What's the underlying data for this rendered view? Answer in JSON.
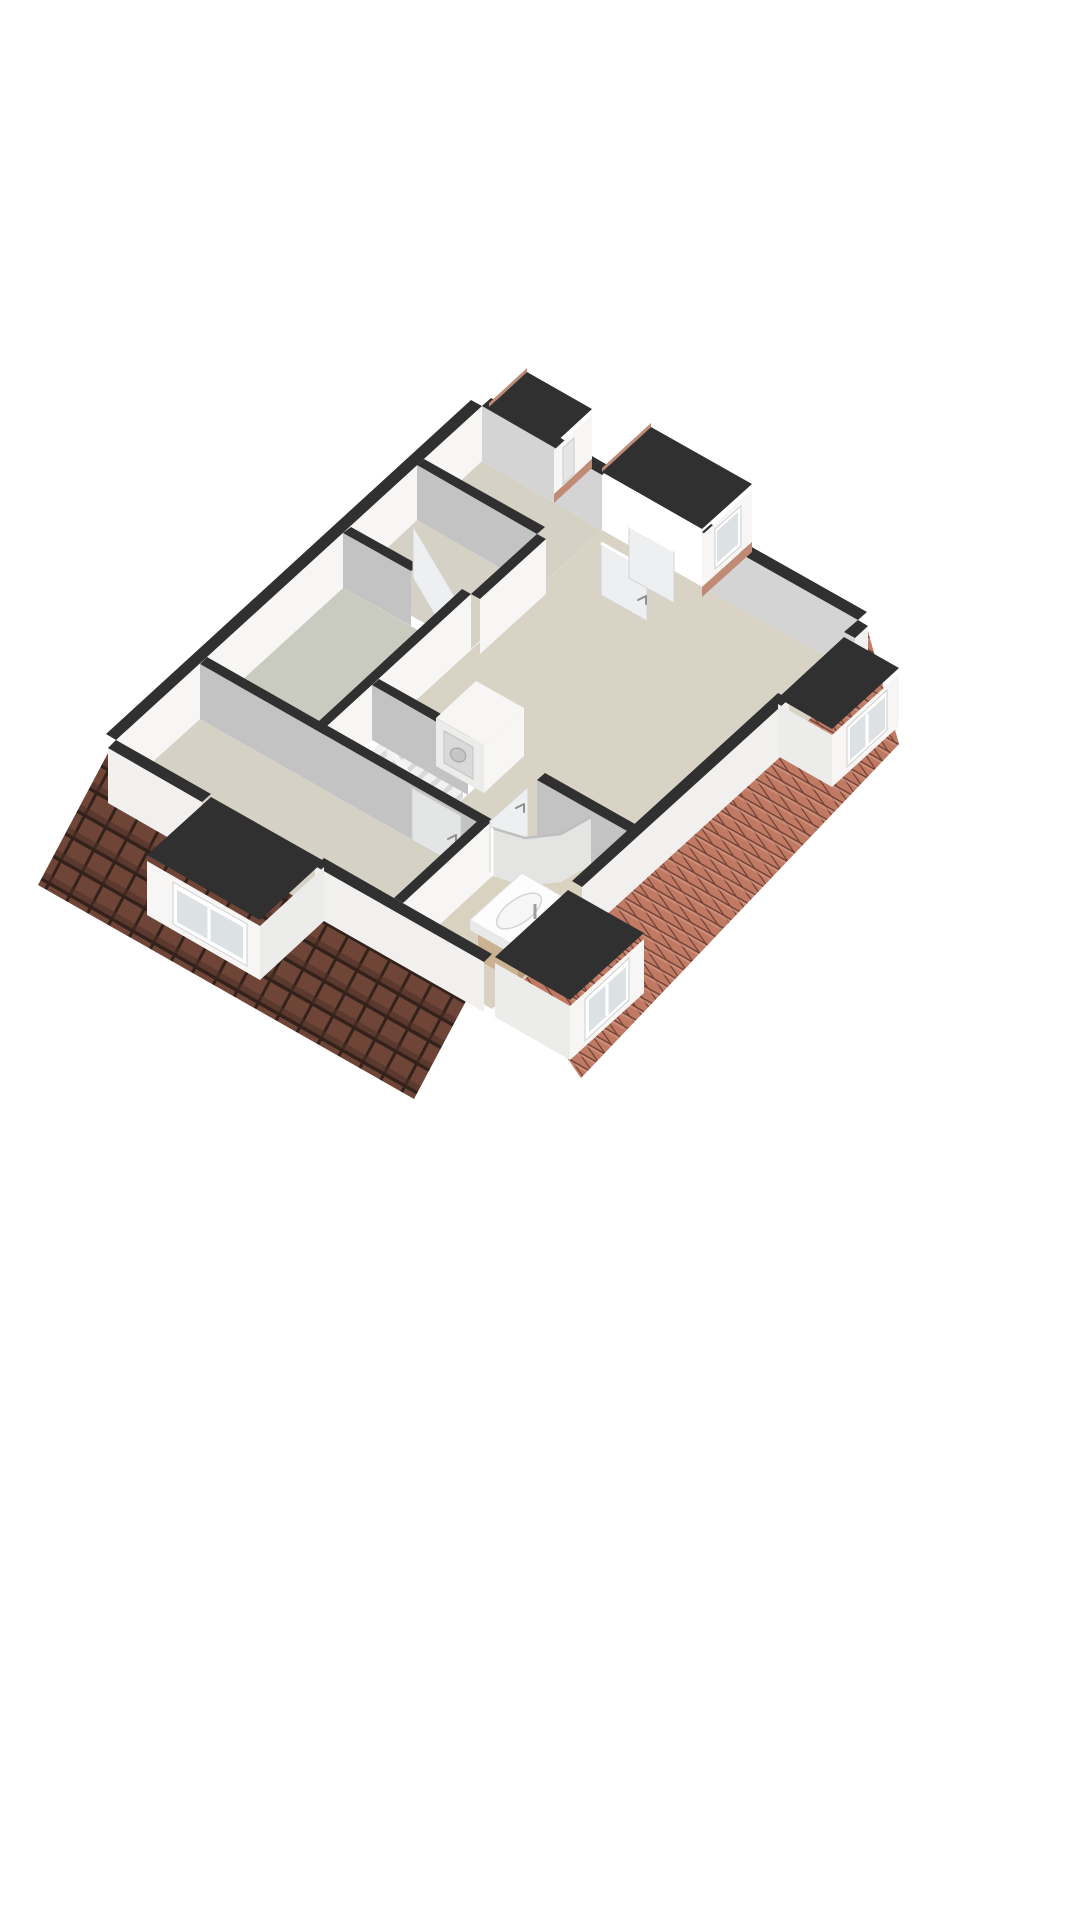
{
  "meta": {
    "kind": "3d-floorplan-render",
    "description": "Axonometric 3D floor plan of an attic storey on a white background, cut walls with dark caps, beige floors, terracotta roof slopes, dormer windows, stairwell, bathroom with shower and sink",
    "text_labels": []
  },
  "colors": {
    "background": "#ffffff",
    "cap": "#303030",
    "wallWhite": "#f7f6f4",
    "wallWhiteDim": "#ececea",
    "wallGray": "#c3c3c3",
    "wallGrayLight": "#d4d4d4",
    "exteriorWhite": "#f1f0ee",
    "floorMain": "#d8d3c5",
    "floorRoom": "#d5d1c5",
    "floorRoomGray": "#c9cbc0",
    "floorBath": "#d9d2c0",
    "voidWhite": "#ffffff",
    "roofDarkTile": "#6e4537",
    "roofDarkGap": "#33211b",
    "roofDarkShade": "#4a2f27",
    "roofBrightTile": "#c07a63",
    "roofBrightGap": "#75453a",
    "roofBrightHi": "#d59a83",
    "roofSliver": "#c08a74",
    "wood": "#cbb292",
    "woodDark": "#b89d7d",
    "windowGlass": "#dce2e4",
    "showerGlass": "#e4e4e3",
    "frameWhite": "#ffffff",
    "doorLeaf": "#edeff0",
    "stairTread": "#f1f1f1",
    "stairRiser": "#d9d9d9",
    "railing": "#f5f5f5",
    "handle": "#8f8f8f"
  },
  "scene": {
    "rooms": [
      {
        "name": "bedroom-left",
        "floor": "floorRoom"
      },
      {
        "name": "room-top-center",
        "floor": "floorRoomGray"
      },
      {
        "name": "room-top-middle",
        "floor": "floorRoom"
      },
      {
        "name": "bedroom-top-right",
        "floor": "floorRoom"
      },
      {
        "name": "landing-hallway",
        "floor": "floorMain"
      },
      {
        "name": "bathroom",
        "floor": "floorBath"
      },
      {
        "name": "stairwell-void",
        "floor": "voidWhite"
      }
    ],
    "roofs": [
      {
        "name": "roof-slope-southwest",
        "shading": "dark"
      },
      {
        "name": "roof-slope-southeast",
        "shading": "bright"
      }
    ],
    "dormers": [
      {
        "name": "dormer-left",
        "window_panes": 2
      },
      {
        "name": "dormer-bottom",
        "window_panes": 2
      },
      {
        "name": "dormer-right",
        "window_panes": 2
      },
      {
        "name": "dormer-top-right",
        "window_panes": 1
      },
      {
        "name": "dormer-top",
        "window_panes": 1
      }
    ],
    "fixtures": [
      {
        "name": "staircase",
        "steps": 7
      },
      {
        "name": "stair-railing"
      },
      {
        "name": "washer-closet"
      },
      {
        "name": "washing-machine"
      },
      {
        "name": "shower-enclosure",
        "shape": "quarter-round"
      },
      {
        "name": "sink-vanity"
      },
      {
        "name": "wash-basin"
      },
      {
        "name": "faucet"
      }
    ],
    "doors": [
      {
        "name": "door-bedroom"
      },
      {
        "name": "door-room-top-center"
      },
      {
        "name": "door-bathroom"
      },
      {
        "name": "door-leaf-open-1"
      },
      {
        "name": "door-leaf-open-2"
      }
    ]
  }
}
